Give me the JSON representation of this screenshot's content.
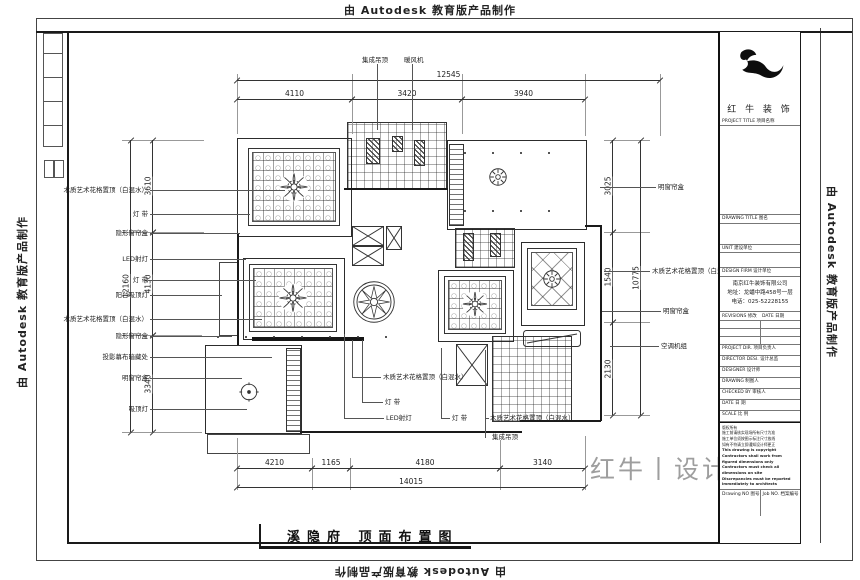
{
  "autodesk_banner": "由 Autodesk 教育版产品制作",
  "sheet_title": {
    "text": "溪隐府 顶面布置图"
  },
  "brand_watermark": {
    "text": "红牛丨设计"
  },
  "top_labels": [
    {
      "text": "集成吊顶"
    },
    {
      "text": "暖风机"
    }
  ],
  "left_labels": [
    {
      "text": "木质艺术花格置顶（白混水）"
    },
    {
      "text": "灯 带"
    },
    {
      "text": "隐形窗帘盒"
    },
    {
      "text": "LED射灯"
    },
    {
      "text": "灯 带"
    },
    {
      "text": "阳台吸顶灯"
    },
    {
      "text": "木质艺术花格置顶（白混水）"
    },
    {
      "text": "隐形窗帘盒"
    },
    {
      "text": "投影幕布暗藏处"
    },
    {
      "text": "明窗帘盒"
    },
    {
      "text": "吸顶灯"
    }
  ],
  "right_labels": [
    {
      "text": "明窗帘盒"
    },
    {
      "text": "木质艺术花格置顶（白混水）"
    },
    {
      "text": "明窗帘盒"
    },
    {
      "text": "空调机组"
    }
  ],
  "bottom_labels": [
    {
      "text": "木质艺术花格置顶（白混水）"
    },
    {
      "text": "灯 带"
    },
    {
      "text": "LED射灯"
    },
    {
      "text": "灯 带"
    },
    {
      "text": "木质艺术花格置顶（白混水）"
    },
    {
      "text": "集成吊顶"
    }
  ],
  "dims": {
    "top_total": "12545",
    "top_segments": [
      "4110",
      "3420",
      "3940"
    ],
    "left_outer": "12160",
    "left_segments": [
      "3610",
      "4130",
      "3340"
    ],
    "right_outer": "10775",
    "right_segments": [
      "3025",
      "1540",
      "2130"
    ],
    "bottom_segments": [
      "4210",
      "1165",
      "4180",
      "3140"
    ],
    "bottom_total": "14015"
  },
  "title_block": {
    "brand": "红 牛 装 饰",
    "project_title": "PROJECT TITLE 项目名称",
    "drawing_title": "DRAWING TITLE 图名",
    "unit": "UNIT 建设单位",
    "design_firm": "DESIGN FIRM 设计单位",
    "firm": {
      "name": "南京红牛装饰有限公司",
      "address": "地址：龙蟠中路458号一层",
      "phone": "电话：025-52228155"
    },
    "revisions": "REVISIONS 修改",
    "rev_date": "DATE 日期",
    "people": [
      {
        "label": "PROJECT DIR. 项目负责人"
      },
      {
        "label": "DIRECTOR DESI. 设计总监"
      },
      {
        "label": "DESIGNER 设计师"
      },
      {
        "label": "DRAWING 制图人"
      },
      {
        "label": "CHECKED BY 审核人"
      },
      {
        "label": "DATE 日 期"
      },
      {
        "label": "SCALE 比 例"
      }
    ],
    "notes": [
      "版权所有",
      "施工前请核实现场所有尺寸为准",
      "施工单位须按图示标注尺寸放线",
      "如有不符请立即通知设计师更正",
      "This drawing is copyright",
      "Contractors shall work from figured dimensions only",
      "Contractors must check all dimensions on site",
      "Discrepancies must be reported immediately to architects"
    ],
    "drawing_no": "Drawing NO 图号",
    "job_no": "Job NO. 档案编号"
  }
}
